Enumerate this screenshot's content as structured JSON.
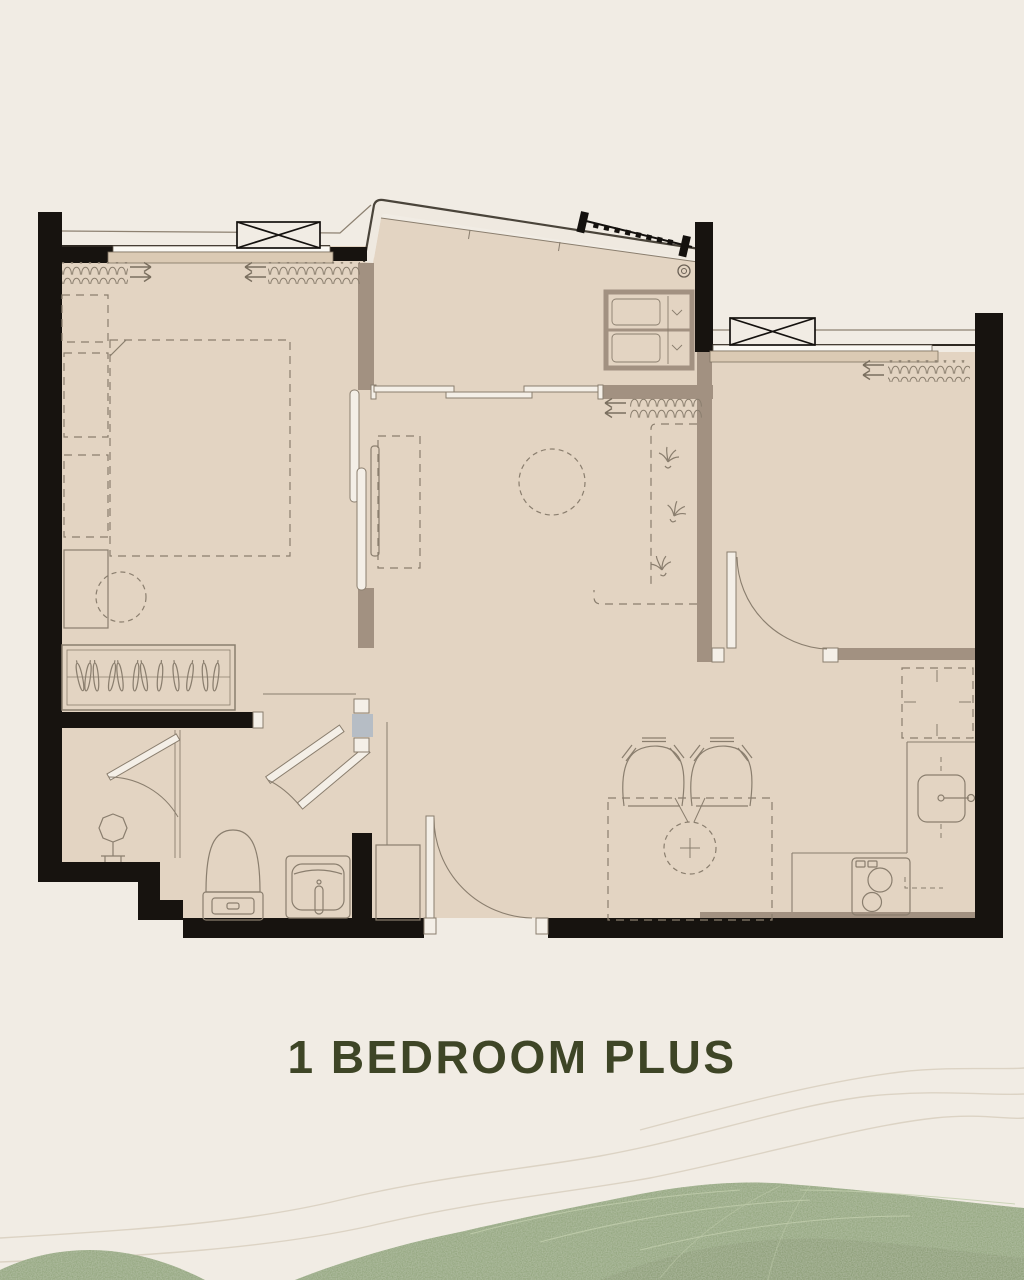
{
  "title": {
    "text": "1 BEDROOM PLUS",
    "color": "#3e4526"
  },
  "palette": {
    "background": "#f1ece4",
    "floor": "#e3d4c2",
    "exterior_wall": "#17130f",
    "interior_wall": "#a29181",
    "drawing_line": "#8a7e6e",
    "window_sill": "#dbcab4",
    "glass": "#fbf9f4",
    "column_shade": "#b6bdc5",
    "balcony_band": "#efe9e0",
    "hill_green": "#8ba075",
    "hill_green_dark": "#81956b",
    "hill_streak": "#c3cfae",
    "contour_line": "#dcd3c4"
  },
  "floorplan": {
    "kind": "apartment unit floor plan",
    "fixture_icons": [
      "double-bed-icon",
      "nightstand-icon",
      "dresser-icon",
      "pouf-icon",
      "wardrobe-hangers-icon",
      "sliding-door-icon",
      "toilet-icon",
      "vanity-sink-icon",
      "pivot-doors-icon",
      "entry-door-icon",
      "dining-chair-icon",
      "dining-table-icon",
      "kitchen-counter-icon",
      "kitchen-sink-icon",
      "cooktop-icon",
      "refrigerator-icon",
      "balcony-railing-icon",
      "ac-condenser-icon",
      "window-symbol-icon",
      "insulation-batting-icon"
    ]
  }
}
